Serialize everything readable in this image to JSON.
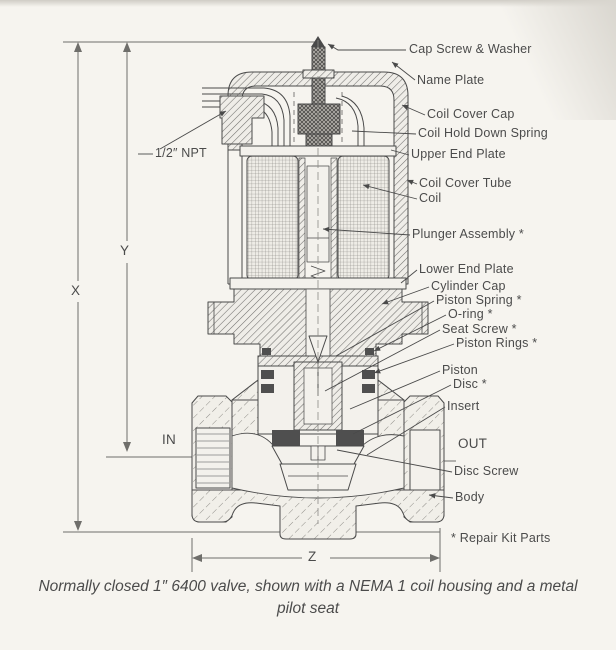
{
  "figure": {
    "caption": "Normally closed 1″ 6400 valve, shown with a NEMA 1 coil housing and a metal pilot seat",
    "footnote": "* Repair Kit Parts"
  },
  "part_labels": {
    "cap_screw_washer": "Cap Screw & Washer",
    "name_plate": "Name Plate",
    "coil_cover_cap": "Coil Cover Cap",
    "coil_hold_down_spring": "Coil Hold Down Spring",
    "upper_end_plate": "Upper End Plate",
    "coil_cover_tube": "Coil Cover Tube",
    "coil": "Coil",
    "plunger_assembly": "Plunger Assembly *",
    "lower_end_plate": "Lower End Plate",
    "cylinder_cap": "Cylinder Cap",
    "piston_spring": "Piston Spring *",
    "o_ring": "O-ring *",
    "seat_screw": "Seat Screw *",
    "piston_rings": "Piston Rings *",
    "piston": "Piston",
    "disc": "Disc *",
    "insert": "Insert",
    "disc_screw": "Disc Screw",
    "body": "Body"
  },
  "dimension_labels": {
    "x": "X",
    "y": "Y",
    "z": "Z",
    "conduit_size": "1/2″ NPT",
    "inlet_port": "IN",
    "outlet_port": "OUT"
  },
  "colors": {
    "background": "#f6f4ef",
    "drawing_line": "#4a4a4a",
    "dimension_line": "#6f6e6b",
    "dark_part": "#4f4f4f"
  }
}
